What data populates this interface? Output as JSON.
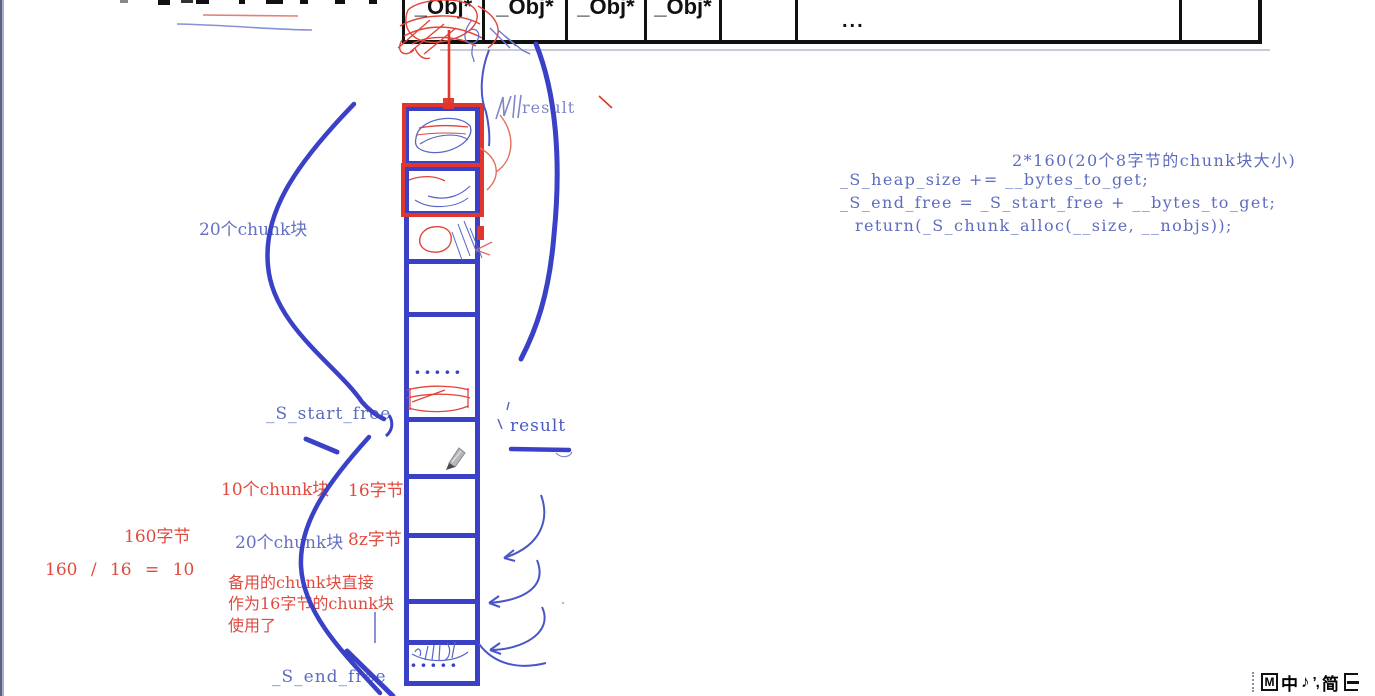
{
  "colors": {
    "ink_blue": "#3a41c6",
    "text_blue": "#5d6cc0",
    "light_blue": "#7e88c9",
    "ink_red": "#e0362c",
    "text_red": "#e04a3f",
    "table_border_black": "#111111"
  },
  "table": {
    "cells": [
      "_Obj*",
      "_Obj*",
      "_Obj*",
      "_Obj*",
      "",
      "...",
      ""
    ]
  },
  "stack": {
    "dots_mid": "·····",
    "dots_bottom": "·····",
    "top_pointer_label": "result",
    "mid_pointer_label": "result"
  },
  "labels": {
    "chunk20_top": "20个chunk块",
    "s_start_free": "_S_start_free",
    "s_end_free": "_S_end_free",
    "chunk10": "10个chunk块",
    "bytes16": "16字节",
    "bytes160": "160字节",
    "chunk20_mid": "20个chunk块",
    "bytes8z": "8z字节",
    "calc": "160 / 16 = 10",
    "note_line1": "备用的chunk块直接",
    "note_line2": "作为16字节的chunk块",
    "note_line3": "使用了"
  },
  "code": {
    "line1": "2*160(20个8字节的chunk块大小)",
    "line2": "_S_heap_size += __bytes_to_get;",
    "line3": "_S_end_free = _S_start_free + __bytes_to_get;",
    "line4": "return(_S_chunk_alloc(__size, __nobjs));"
  },
  "ime": {
    "items": [
      "M",
      "中",
      "♪",
      "’,",
      "简"
    ]
  }
}
